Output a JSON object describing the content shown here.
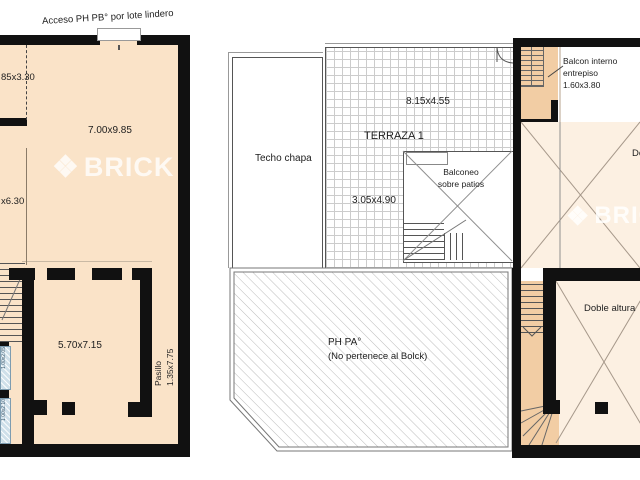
{
  "left_plan": {
    "access_label": "Acceso PH PB° por lote lindero",
    "dims": {
      "upper_left": "85x3.30",
      "main": "7.00x9.85",
      "mid_left": "x6.30",
      "room": "5.70x7.15",
      "window_upper": "1.00x2.05",
      "window_lower": "1.00x2.10"
    },
    "pasillo": {
      "label": "Pasillo",
      "dim": "1.35x7.75"
    }
  },
  "right_plan": {
    "techo_chapa_label": "Techo chapa",
    "terraza": {
      "name": "TERRAZA 1",
      "dim_main": "8.15x4.55",
      "dim_lower": "3.05x4.90"
    },
    "balconeo": {
      "line1": "Balconeo",
      "line2": "sobre patios"
    },
    "balcon_interno": {
      "line1": "Balcon interno",
      "line2": "entrepiso",
      "line3": "1.60x3.80"
    },
    "ph_pa": {
      "line1": "PH PA°",
      "line2": "(No pertenece al Bolck)"
    },
    "doble_altura_label": "Doble altura",
    "doble_altura_upper_label": "Doble altura"
  },
  "watermark": {
    "brand": "BRICK",
    "icon": "diamond-icon",
    "glyph": "❖"
  },
  "colors": {
    "wall": "#111111",
    "plan_cream": "#fae3c8",
    "room_cream": "#fcf0e2",
    "stair_orange": "#f2cda4",
    "window_blue": "#cfe0ea",
    "hatch_gray": "#bbbbbb",
    "grid_gray": "#cccccc",
    "watermark_white": "rgba(255,255,255,0.78)"
  }
}
